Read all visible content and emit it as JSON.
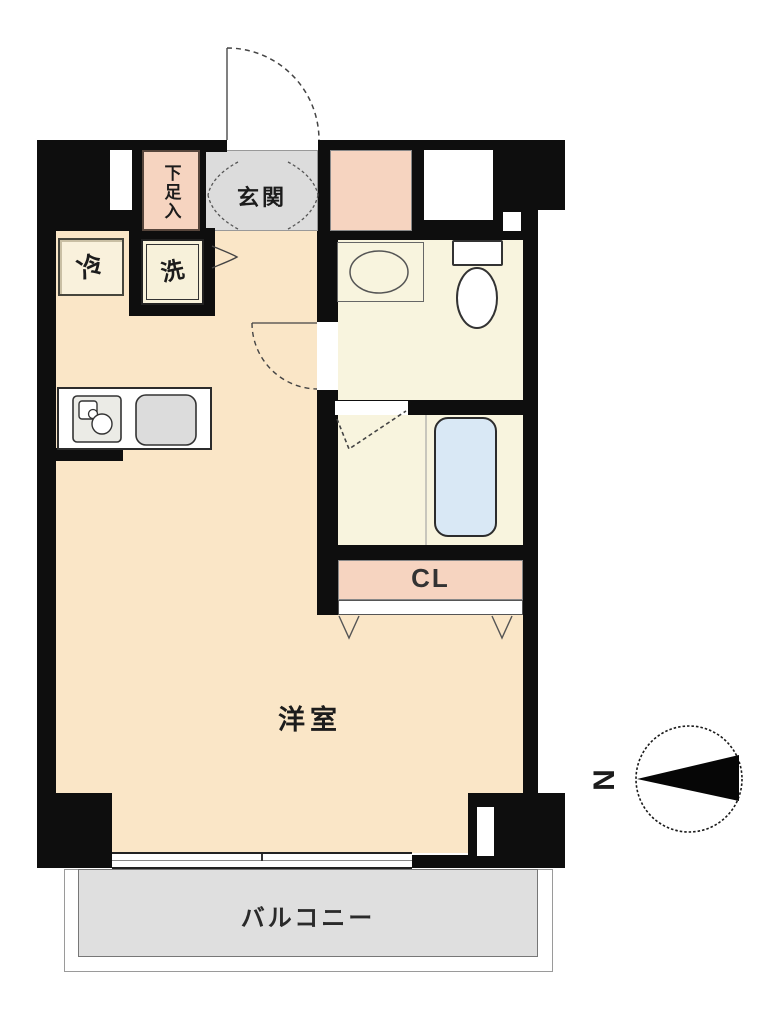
{
  "labels": {
    "entrance": "玄関",
    "shoe_storage": "下足入",
    "refrigerator": "冷",
    "washer": "洗",
    "closet": "CL",
    "western_room": "洋室",
    "balcony": "バルコニー",
    "compass_north": "N"
  },
  "colors": {
    "wall": "#0e0e0e",
    "room_floor": "#FAE6C7",
    "wet_floor": "#F8F4DE",
    "accent_salmon": "#F6D4C0",
    "entrance_gray": "#DCDCDC",
    "balcony_gray": "#DFDFDF",
    "tub_blue": "#D9E8F5"
  }
}
